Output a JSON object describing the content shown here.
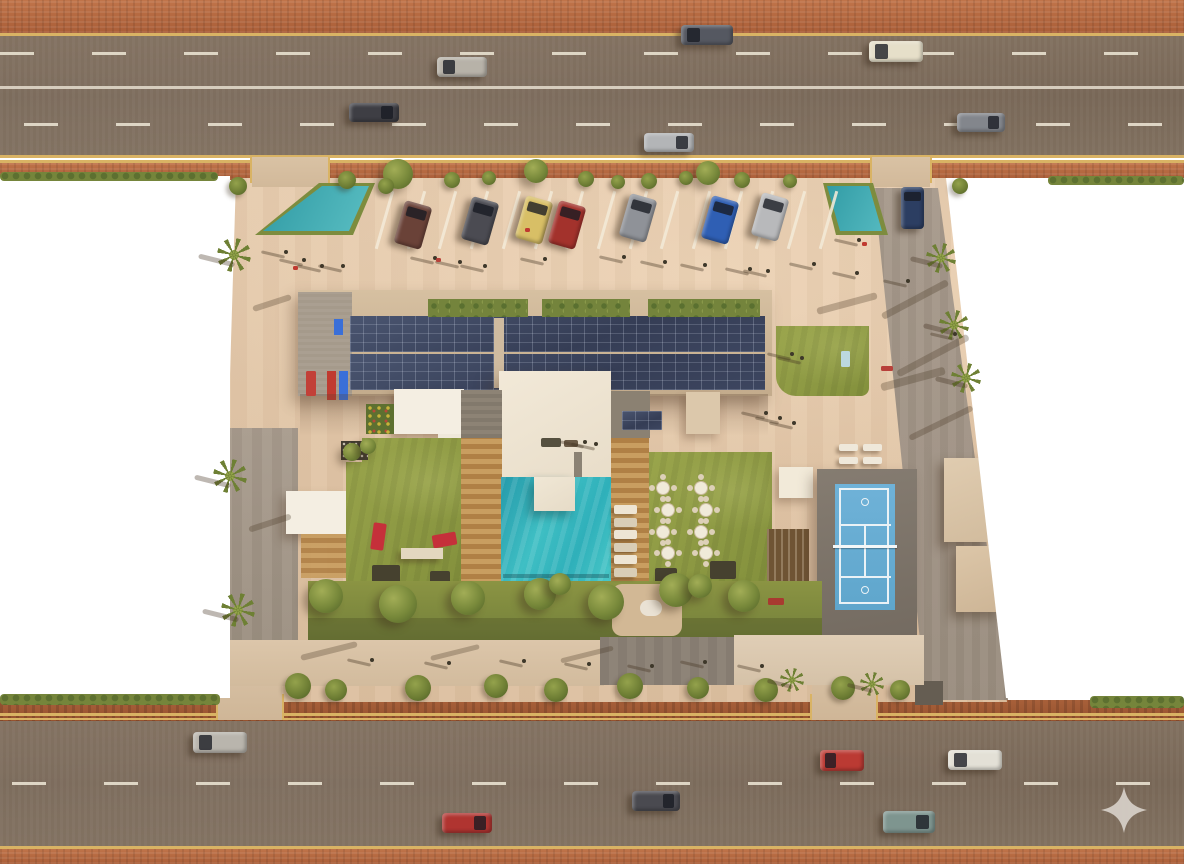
{
  "scene": {
    "description": "Aerial top-down 3D architectural rendering of a residential complex between two multi-lane roads, with rooftop solar panels, swimming pool, lawns, dining terrace, tennis court, parking court and perimeter palm trees",
    "palette": {
      "asphalt": "#7c6b5e",
      "brick_sidewalk": "#b4683c",
      "curb_yellow": "#d9b364",
      "lane_marking": "#e3dbca",
      "plaza_paving": "#e3c7a9",
      "lawn": "#8f9c44",
      "pool_water": "#3bbac1",
      "solar_panel": "#3b445c",
      "roof_cream": "#eee4d2",
      "wood_deck": "#c0955a",
      "tennis_court": "#68aed4",
      "mulch": "#9e5a34",
      "blank_background": "#ffffff",
      "watermark": "#d6cfc8"
    },
    "watermark": {
      "icon": "sparkle-watermark-icon",
      "x": 1100,
      "y": 786,
      "size": 48,
      "color": "#d6cfc8"
    },
    "moving_cars": [
      {
        "x": 437,
        "y": 57,
        "w": 50,
        "h": 20,
        "color": "#b7b2a8",
        "dir": "l"
      },
      {
        "x": 349,
        "y": 103,
        "w": 50,
        "h": 19,
        "color": "#3e3e44",
        "dir": "r"
      },
      {
        "x": 681,
        "y": 25,
        "w": 52,
        "h": 20,
        "color": "#555861",
        "dir": "l"
      },
      {
        "x": 869,
        "y": 41,
        "w": 54,
        "h": 21,
        "color": "#e6dfc9",
        "dir": "l"
      },
      {
        "x": 957,
        "y": 113,
        "w": 48,
        "h": 19,
        "color": "#83868c",
        "dir": "r"
      },
      {
        "x": 644,
        "y": 133,
        "w": 50,
        "h": 19,
        "color": "#b3b5b7",
        "dir": "r"
      },
      {
        "x": 193,
        "y": 732,
        "w": 54,
        "h": 21,
        "color": "#b9b5ad",
        "dir": "l"
      },
      {
        "x": 442,
        "y": 813,
        "w": 50,
        "h": 20,
        "color": "#b03430",
        "dir": "r"
      },
      {
        "x": 820,
        "y": 750,
        "w": 44,
        "h": 21,
        "color": "#bb3a33",
        "dir": "l"
      },
      {
        "x": 948,
        "y": 750,
        "w": 54,
        "h": 20,
        "color": "#e3e0d6",
        "dir": "l"
      },
      {
        "x": 632,
        "y": 791,
        "w": 48,
        "h": 20,
        "color": "#4a4a50",
        "dir": "r"
      },
      {
        "x": 883,
        "y": 811,
        "w": 52,
        "h": 22,
        "color": "#7e958f",
        "dir": "r"
      }
    ],
    "parked_cars": [
      {
        "x": 399,
        "y": 203,
        "color": "#6a4238"
      },
      {
        "x": 466,
        "y": 199,
        "color": "#4b4b52"
      },
      {
        "x": 520,
        "y": 198,
        "color": "#d8bf66"
      },
      {
        "x": 553,
        "y": 203,
        "color": "#a3322c"
      },
      {
        "x": 624,
        "y": 196,
        "color": "#8f9298"
      },
      {
        "x": 706,
        "y": 198,
        "color": "#2f5fb4"
      },
      {
        "x": 756,
        "y": 195,
        "color": "#b8b9bb"
      }
    ],
    "parked_car_size": {
      "w": 28,
      "h": 44,
      "angle": 16
    },
    "entering_car": {
      "x": 901,
      "y": 187,
      "w": 23,
      "h": 42,
      "color": "#2c3e62"
    },
    "parking_lines": {
      "x0": 383,
      "y": 190,
      "count": 15,
      "step": 31.7,
      "len": 60
    },
    "palms": [
      [
        234,
        255,
        34
      ],
      [
        230,
        476,
        34
      ],
      [
        238,
        610,
        34
      ],
      [
        941,
        258,
        30
      ],
      [
        954,
        325,
        30
      ],
      [
        966,
        378,
        30
      ],
      [
        792,
        680,
        24
      ],
      [
        872,
        684,
        24
      ]
    ],
    "trees": [
      [
        398,
        174,
        15
      ],
      [
        536,
        171,
        12
      ],
      [
        708,
        173,
        12
      ],
      [
        326,
        596,
        17
      ],
      [
        398,
        604,
        19
      ],
      [
        468,
        598,
        17
      ],
      [
        540,
        594,
        16
      ],
      [
        606,
        602,
        18
      ],
      [
        676,
        590,
        17
      ],
      [
        744,
        596,
        16
      ],
      [
        700,
        586,
        12
      ],
      [
        560,
        584,
        11
      ],
      [
        352,
        452,
        9
      ],
      [
        368,
        446,
        8
      ]
    ],
    "bushes": [
      [
        347,
        180,
        9
      ],
      [
        386,
        186,
        8
      ],
      [
        452,
        180,
        8
      ],
      [
        489,
        178,
        7
      ],
      [
        586,
        179,
        8
      ],
      [
        618,
        182,
        7
      ],
      [
        649,
        181,
        8
      ],
      [
        686,
        178,
        7
      ],
      [
        742,
        180,
        8
      ],
      [
        790,
        181,
        7
      ],
      [
        298,
        686,
        13
      ],
      [
        336,
        690,
        11
      ],
      [
        418,
        688,
        13
      ],
      [
        496,
        686,
        12
      ],
      [
        556,
        690,
        12
      ],
      [
        630,
        686,
        13
      ],
      [
        698,
        688,
        11
      ],
      [
        766,
        690,
        12
      ],
      [
        843,
        688,
        12
      ],
      [
        900,
        690,
        10
      ],
      [
        238,
        186,
        9
      ],
      [
        960,
        186,
        8
      ]
    ],
    "people": [
      [
        284,
        250
      ],
      [
        302,
        258
      ],
      [
        320,
        264
      ],
      [
        341,
        264
      ],
      [
        433,
        256
      ],
      [
        458,
        260
      ],
      [
        483,
        264
      ],
      [
        543,
        257
      ],
      [
        622,
        255
      ],
      [
        663,
        260
      ],
      [
        703,
        263
      ],
      [
        748,
        267
      ],
      [
        766,
        269
      ],
      [
        812,
        262
      ],
      [
        855,
        271
      ],
      [
        906,
        279
      ],
      [
        953,
        332
      ],
      [
        790,
        352
      ],
      [
        800,
        356
      ],
      [
        583,
        440
      ],
      [
        594,
        442
      ],
      [
        764,
        411
      ],
      [
        778,
        416
      ],
      [
        792,
        421
      ],
      [
        370,
        658
      ],
      [
        447,
        661
      ],
      [
        522,
        659
      ],
      [
        587,
        662
      ],
      [
        650,
        664
      ],
      [
        703,
        660
      ],
      [
        760,
        664
      ],
      [
        857,
        238
      ]
    ],
    "props": [
      {
        "x": 293,
        "y": 266,
        "w": 5,
        "h": 4,
        "color": "#c03a30"
      },
      {
        "x": 525,
        "y": 228,
        "w": 5,
        "h": 4,
        "color": "#c03a30"
      },
      {
        "x": 436,
        "y": 258,
        "w": 5,
        "h": 4,
        "color": "#b84038"
      },
      {
        "x": 881,
        "y": 366,
        "w": 12,
        "h": 5,
        "color": "#b8403a"
      },
      {
        "x": 841,
        "y": 351,
        "w": 9,
        "h": 16,
        "color": "#bcd8e0"
      },
      {
        "x": 306,
        "y": 371,
        "w": 10,
        "h": 25,
        "color": "#c24038"
      },
      {
        "x": 862,
        "y": 242,
        "w": 5,
        "h": 4,
        "color": "#c03a30"
      },
      {
        "x": 768,
        "y": 598,
        "w": 16,
        "h": 7,
        "color": "#a83a30"
      }
    ],
    "dining_tables": [
      [
        663,
        488
      ],
      [
        701,
        488
      ],
      [
        668,
        510
      ],
      [
        706,
        510
      ],
      [
        663,
        532
      ],
      [
        701,
        532
      ],
      [
        668,
        553
      ],
      [
        706,
        553
      ]
    ],
    "deck_loungers": {
      "x": 614,
      "w": 23,
      "h": 9,
      "ys": [
        505,
        518,
        530,
        543,
        555,
        568
      ],
      "colors": [
        "#eee5d4",
        "#d9cdb6"
      ]
    },
    "plaza_loungers": {
      "w": 19,
      "h": 7,
      "color": "#efe8da",
      "positions": [
        [
          839,
          444
        ],
        [
          863,
          444
        ],
        [
          839,
          457
        ],
        [
          863,
          457
        ]
      ]
    },
    "shadow_streaks": [
      [
        878,
        296,
        74,
        7,
        -28
      ],
      [
        893,
        352,
        80,
        7,
        -28
      ],
      [
        906,
        420,
        70,
        6,
        -26
      ],
      [
        880,
        375,
        66,
        8,
        -15
      ],
      [
        816,
        300,
        62,
        7,
        -15
      ],
      [
        300,
        648,
        58,
        6,
        -14
      ],
      [
        430,
        650,
        50,
        5,
        -14
      ],
      [
        560,
        652,
        54,
        5,
        -14
      ],
      [
        252,
        300,
        40,
        6,
        -18
      ],
      [
        248,
        520,
        44,
        6,
        -18
      ]
    ]
  }
}
